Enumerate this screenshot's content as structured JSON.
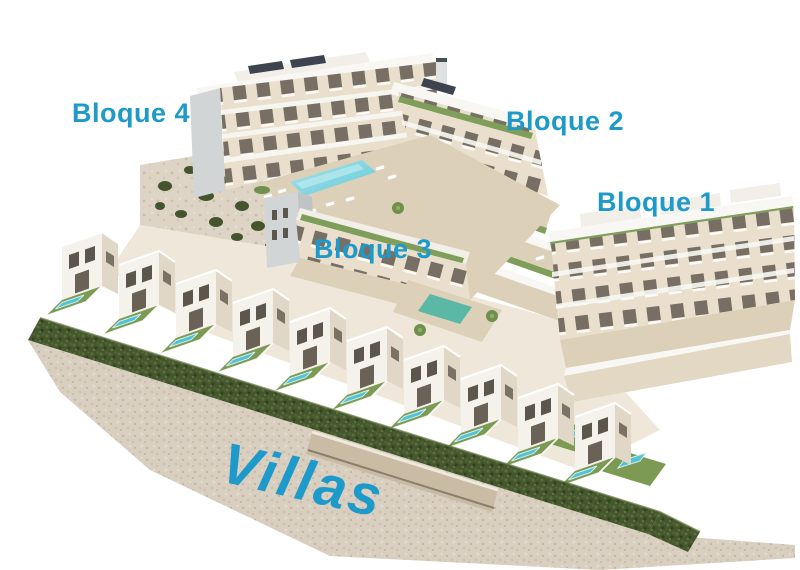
{
  "scene": {
    "type": "aerial-3d-architectural-render",
    "description": "Aerial 3D rendering of a white Mediterranean residential development: four apartment blocks around a communal pool on the upper terrace, a long diagonal row of townhouse villas with private pools and lawns in the foreground, a dark clipped hedge and stone retaining wall along the lower edge, all on a white background.",
    "labels": {
      "bloque4": "Bloque 4",
      "bloque2": "Bloque 2",
      "bloque1": "Bloque 1",
      "bloque3": "Bloque 3",
      "villas": "Villas"
    },
    "colors": {
      "label_blue": "#1d9aca",
      "background": "#ffffff",
      "facade_cream": "#e9dfcc",
      "deck_beige": "#dcd0b9",
      "wall_white": "#f8f7f3",
      "gable_gray": "#d2d5d6",
      "window_dark": "#5c564c",
      "pool_turquoise": "#52c3d4",
      "pool_light": "#aee6ec",
      "lawn_green": "#7c9a53",
      "hedge_green": "#44552e",
      "roof_plant_green": "#7f9e5a",
      "stone_beige": "#d9cfc0",
      "rock_tan": "#ddd4c5"
    }
  }
}
